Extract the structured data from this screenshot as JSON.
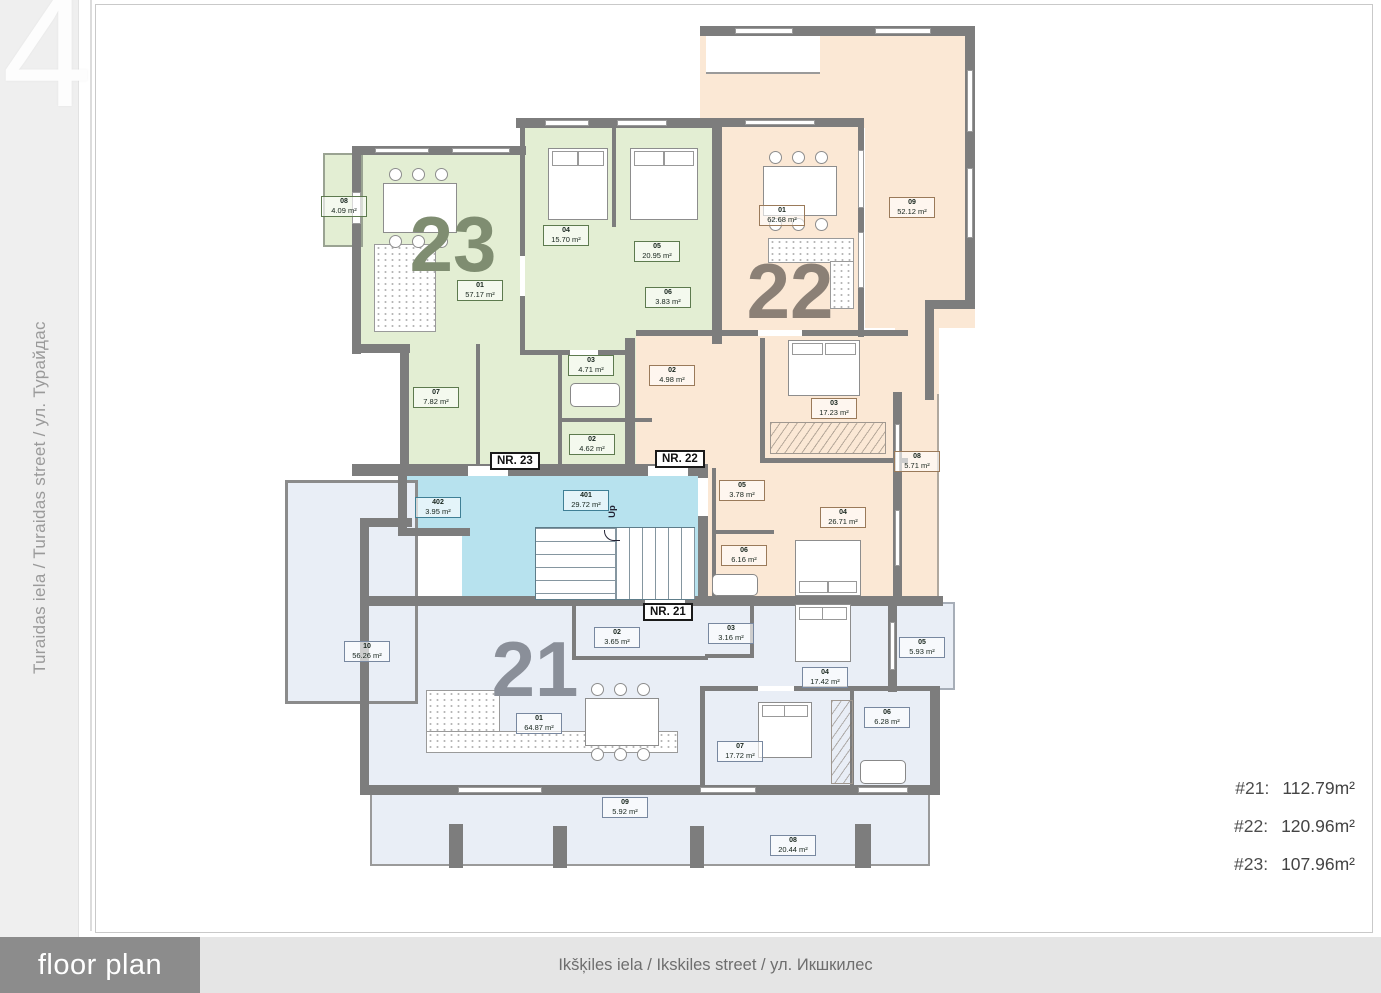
{
  "floor": {
    "number": "4"
  },
  "sidebar": {
    "street": "Turaidas iela / Turaidas street / ул. Турайдас"
  },
  "footer": {
    "plan_label": "floor plan",
    "street": "Ikšķiles iela / Ikskiles street / ул. Икшкилес"
  },
  "summary": [
    {
      "label": "#21:",
      "value": "112.79m²"
    },
    {
      "label": "#22:",
      "value": "120.96m²"
    },
    {
      "label": "#23:",
      "value": "107.96m²"
    }
  ],
  "stairwell": {
    "up_label": "Up",
    "rooms": [
      {
        "code": "401",
        "area": "29.72 m²"
      },
      {
        "code": "402",
        "area": "3.95 m²"
      }
    ]
  },
  "apartments": [
    {
      "number": "21",
      "door_label": "NR. 21",
      "rooms": [
        {
          "code": "01",
          "area": "64.87 m²"
        },
        {
          "code": "02",
          "area": "3.65 m²"
        },
        {
          "code": "03",
          "area": "3.16 m²"
        },
        {
          "code": "04",
          "area": "17.42 m²"
        },
        {
          "code": "05",
          "area": "5.93 m²"
        },
        {
          "code": "06",
          "area": "6.28 m²"
        },
        {
          "code": "07",
          "area": "17.72 m²"
        },
        {
          "code": "08",
          "area": "20.44 m²"
        },
        {
          "code": "09",
          "area": "5.92 m²"
        },
        {
          "code": "10",
          "area": "56.26 m²"
        }
      ]
    },
    {
      "number": "22",
      "door_label": "NR. 22",
      "rooms": [
        {
          "code": "01",
          "area": "62.68 m²"
        },
        {
          "code": "02",
          "area": "4.98 m²"
        },
        {
          "code": "03",
          "area": "17.23 m²"
        },
        {
          "code": "04",
          "area": "26.71 m²"
        },
        {
          "code": "05",
          "area": "3.78 m²"
        },
        {
          "code": "06",
          "area": "6.16 m²"
        },
        {
          "code": "08",
          "area": "5.71 m²"
        },
        {
          "code": "09",
          "area": "52.12 m²"
        }
      ]
    },
    {
      "number": "23",
      "door_label": "NR. 23",
      "rooms": [
        {
          "code": "01",
          "area": "57.17 m²"
        },
        {
          "code": "02",
          "area": "4.62 m²"
        },
        {
          "code": "03",
          "area": "4.71 m²"
        },
        {
          "code": "04",
          "area": "15.70 m²"
        },
        {
          "code": "05",
          "area": "20.95 m²"
        },
        {
          "code": "06",
          "area": "3.83 m²"
        },
        {
          "code": "07",
          "area": "7.82 m²"
        },
        {
          "code": "08",
          "area": "4.09 m²"
        }
      ]
    }
  ],
  "colors": {
    "apt21": "#e9eef6",
    "apt22": "#fbe8d5",
    "apt23": "#e3eed3",
    "stairwell": "#b7e2ee",
    "wall": "#7d7d7d"
  }
}
